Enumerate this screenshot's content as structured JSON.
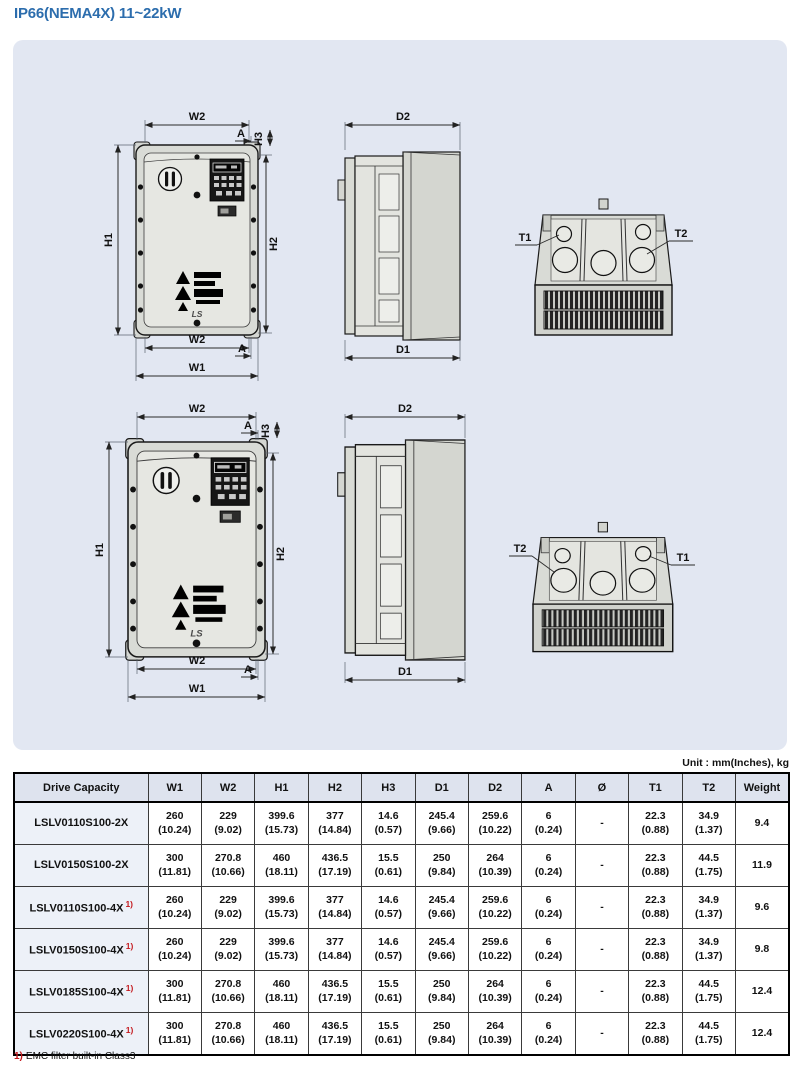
{
  "page": {
    "title": "IP66(NEMA4X) 11~22kW"
  },
  "colors": {
    "title_blue": "#2c6dad",
    "panel_background": "#e2e7f2",
    "table_header_bg": "#dee3ee",
    "model_cell_bg": "#edf1f8",
    "footnote_red": "#c41a1f"
  },
  "diagram": {
    "labels": {
      "w1": "W1",
      "w2": "W2",
      "h1": "H1",
      "h2": "H2",
      "h3": "H3",
      "d1": "D1",
      "d2": "D2",
      "a": "A",
      "t1": "T1",
      "t2": "T2"
    },
    "logo": "LS"
  },
  "table": {
    "unit_note": "Unit : mm(Inches), kg",
    "columns": [
      "Drive Capacity",
      "W1",
      "W2",
      "H1",
      "H2",
      "H3",
      "D1",
      "D2",
      "A",
      "Ø",
      "T1",
      "T2",
      "Weight"
    ],
    "rows": [
      {
        "model": "LSLV0110S100-2X",
        "note_marker": "",
        "cells": [
          "260\n(10.24)",
          "229\n(9.02)",
          "399.6\n(15.73)",
          "377\n(14.84)",
          "14.6\n(0.57)",
          "245.4\n(9.66)",
          "259.6\n(10.22)",
          "6\n(0.24)",
          "-",
          "22.3\n(0.88)",
          "34.9\n(1.37)",
          "9.4"
        ]
      },
      {
        "model": "LSLV0150S100-2X",
        "note_marker": "",
        "cells": [
          "300\n(11.81)",
          "270.8\n(10.66)",
          "460\n(18.11)",
          "436.5\n(17.19)",
          "15.5\n(0.61)",
          "250\n(9.84)",
          "264\n(10.39)",
          "6\n(0.24)",
          "-",
          "22.3\n(0.88)",
          "44.5\n(1.75)",
          "11.9"
        ]
      },
      {
        "model": "LSLV0110S100-4X",
        "note_marker": "1)",
        "cells": [
          "260\n(10.24)",
          "229\n(9.02)",
          "399.6\n(15.73)",
          "377\n(14.84)",
          "14.6\n(0.57)",
          "245.4\n(9.66)",
          "259.6\n(10.22)",
          "6\n(0.24)",
          "-",
          "22.3\n(0.88)",
          "34.9\n(1.37)",
          "9.6"
        ]
      },
      {
        "model": "LSLV0150S100-4X",
        "note_marker": "1)",
        "cells": [
          "260\n(10.24)",
          "229\n(9.02)",
          "399.6\n(15.73)",
          "377\n(14.84)",
          "14.6\n(0.57)",
          "245.4\n(9.66)",
          "259.6\n(10.22)",
          "6\n(0.24)",
          "-",
          "22.3\n(0.88)",
          "34.9\n(1.37)",
          "9.8"
        ]
      },
      {
        "model": "LSLV0185S100-4X",
        "note_marker": "1)",
        "cells": [
          "300\n(11.81)",
          "270.8\n(10.66)",
          "460\n(18.11)",
          "436.5\n(17.19)",
          "15.5\n(0.61)",
          "250\n(9.84)",
          "264\n(10.39)",
          "6\n(0.24)",
          "-",
          "22.3\n(0.88)",
          "44.5\n(1.75)",
          "12.4"
        ]
      },
      {
        "model": "LSLV0220S100-4X",
        "note_marker": "1)",
        "cells": [
          "300\n(11.81)",
          "270.8\n(10.66)",
          "460\n(18.11)",
          "436.5\n(17.19)",
          "15.5\n(0.61)",
          "250\n(9.84)",
          "264\n(10.39)",
          "6\n(0.24)",
          "-",
          "22.3\n(0.88)",
          "44.5\n(1.75)",
          "12.4"
        ]
      }
    ]
  },
  "footnote": {
    "marker": "1)",
    "text": "EMC filter built-in Class3"
  }
}
